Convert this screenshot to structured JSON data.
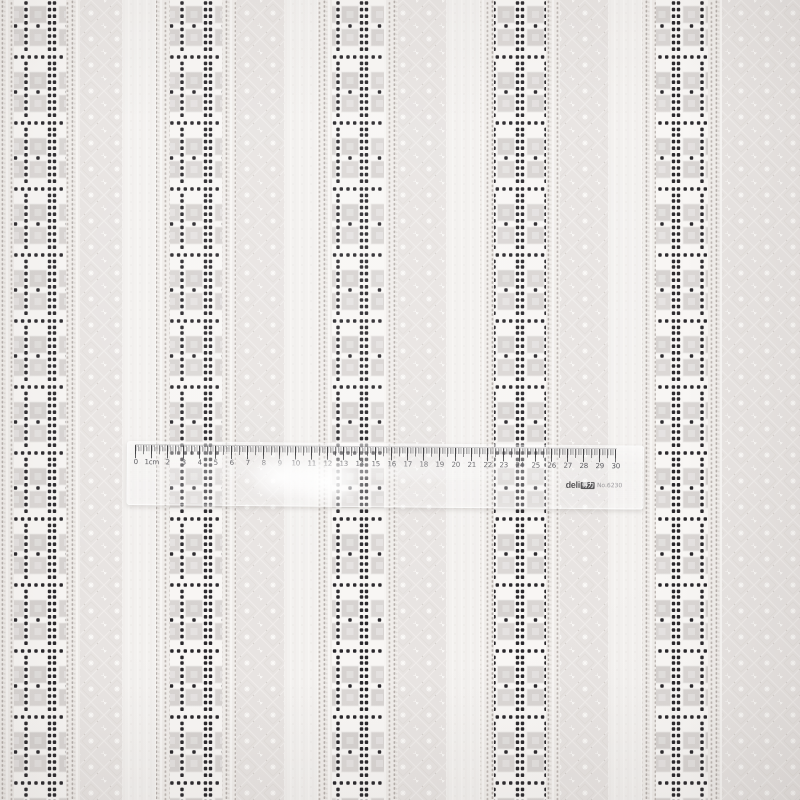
{
  "scene": {
    "description": "White eyelet embroidered fabric with vertical stripes of gray squares and black eyelet holes, diamond lattice ground, measured by a transparent ruler",
    "colors": {
      "fabric_ground": "#e8e4e2",
      "band_white": "#f8f6f4",
      "band_square": "#d9d5d3",
      "eyelet_dot": "#28262a",
      "bright_stripe": "#f3f1ef",
      "stitch_dot": "#b6afab",
      "lattice_line": "#f0edeb",
      "motif_white": "#fbfaf8"
    }
  },
  "ruler": {
    "length_cm": 30,
    "unit_label": "1cm",
    "numbers": [
      "0",
      "1cm",
      "2",
      "3",
      "4",
      "5",
      "6",
      "7",
      "8",
      "9",
      "10",
      "11",
      "12",
      "13",
      "14",
      "15",
      "16",
      "17",
      "18",
      "19",
      "20",
      "21",
      "22",
      "23",
      "24",
      "25",
      "26",
      "27",
      "28",
      "29",
      "30"
    ],
    "brand": "deli",
    "brand_cn": "得力",
    "model": "No.6230"
  }
}
